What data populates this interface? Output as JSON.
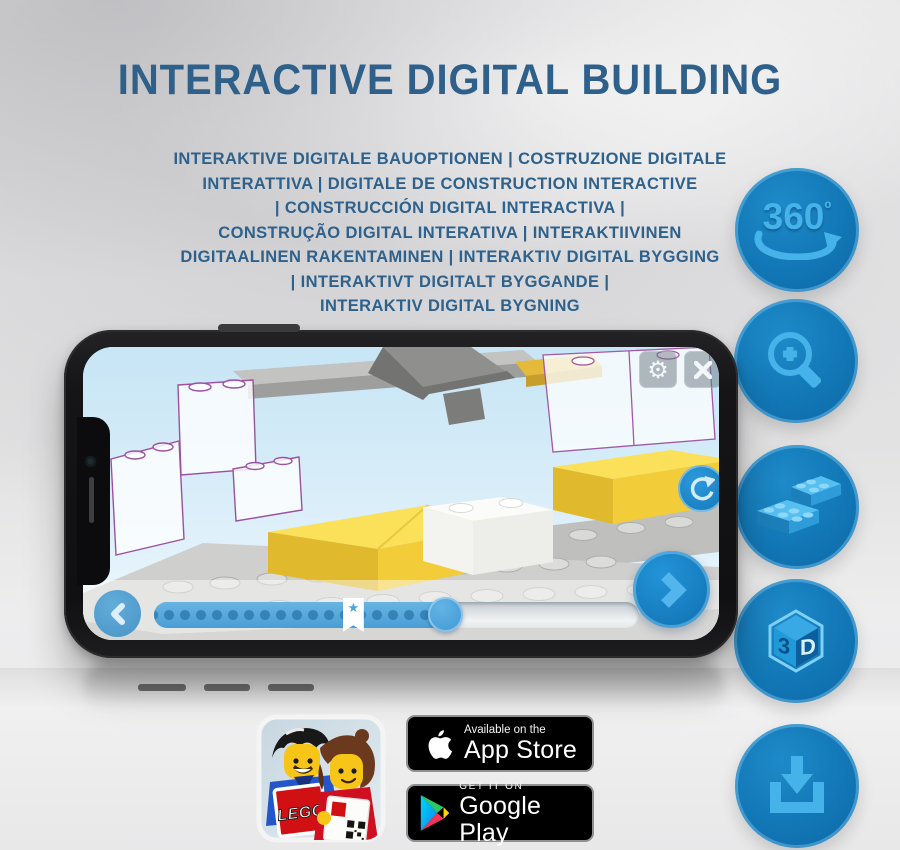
{
  "page": {
    "title": "INTERACTIVE DIGITAL BUILDING"
  },
  "subtitle_lines": [
    "INTERAKTIVE DIGITALE BAUOPTIONEN | COSTRUZIONE DIGITALE",
    "INTERATTIVA | DIGITALE DE CONSTRUCTION INTERACTIVE",
    "| CONSTRUCCIÓN DIGITAL INTERACTIVA |",
    "CONSTRUÇÃO DIGITAL INTERATIVA | INTERAKTIIVINEN",
    "DIGITAALINEN RAKENTAMINEN | INTERAKTIV DIGITAL BYGGING",
    "| INTERAKTIVT DIGITALT BYGGANDE |",
    "INTERAKTIV DIGITAL BYGNING"
  ],
  "feature_rail": {
    "rotation_number": "360",
    "rotation_degree": "º",
    "cube_left": "3",
    "cube_right": "D",
    "icon_names": [
      "rotate-360-icon",
      "zoom-in-icon",
      "bricks-icon",
      "3d-cube-icon",
      "download-icon"
    ]
  },
  "phone_app": {
    "progress": {
      "percent_complete": 60,
      "bookmark_percent": 41
    },
    "icons": {
      "settings": "⚙",
      "bookmark_star": "★"
    },
    "control_names": [
      "settings",
      "close",
      "rotate-model",
      "previous-step",
      "next-step",
      "step-slider"
    ]
  },
  "store_badges": {
    "app_store": {
      "tagline": "Available on the",
      "store": "App Store"
    },
    "google_play": {
      "tagline": "GET IT ON",
      "store": "Google Play"
    }
  },
  "lego_app_icon": {
    "logo": "LEGO"
  },
  "colors": {
    "title_blue": "#2e608a",
    "rail_circle_blue": "#1277b6",
    "rail_glyph_blue": "#45b2e9",
    "screen_sky": "#d6ecf8",
    "brick_yellow": "#fbe059",
    "outline_purple": "#9b51a0",
    "badge_black": "#000000"
  }
}
